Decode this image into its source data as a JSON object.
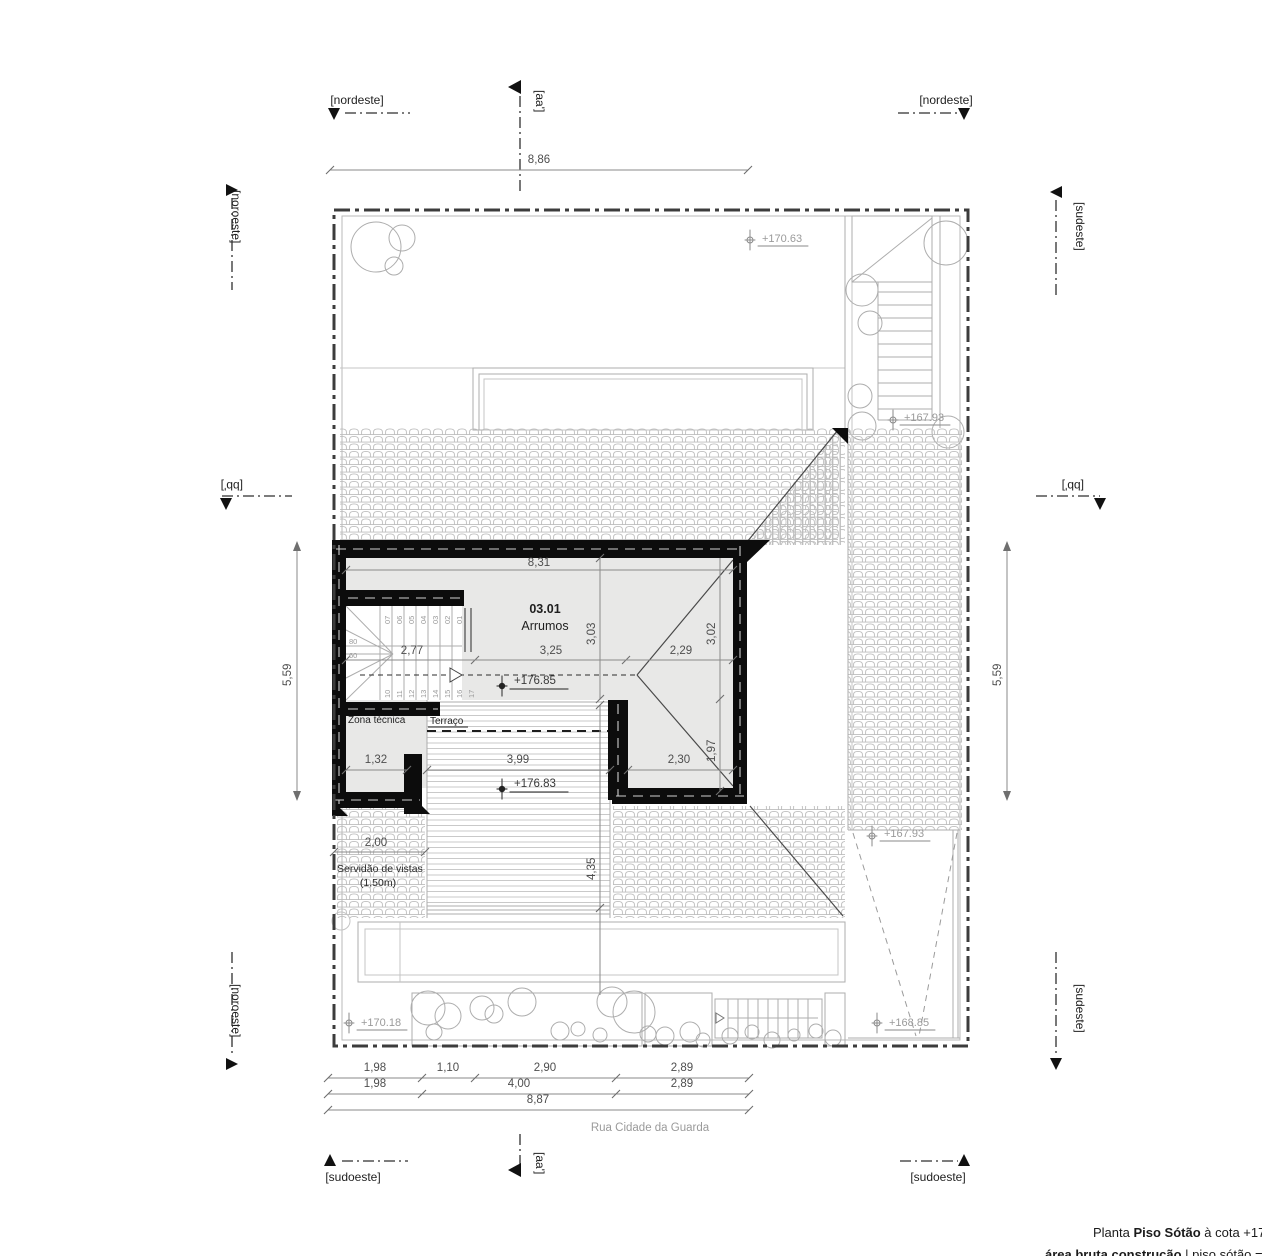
{
  "compass": {
    "nordeste": "[nordeste]",
    "noroeste": "[noroeste]",
    "sudeste": "[sudeste]",
    "sudoeste": "[sudoeste]"
  },
  "sections": {
    "aa": "[aa']",
    "bb": "[bb']"
  },
  "dims": {
    "top": "8,86",
    "side_left": "5,59",
    "side_right": "5,59",
    "room_width": "8,31",
    "room_depth_left": "3,03",
    "room_depth_right": "3,02",
    "room_lower_right": "1,97",
    "stair_width": "2,77",
    "mid_width": "3,25",
    "right_width": "2,29",
    "zona_width": "1,32",
    "terrace_width": "3,99",
    "lower_right_width": "2,30",
    "terrace_length": "4,35",
    "servidao_width": "2,00",
    "row1": [
      "1,98",
      "1,10",
      "2,90",
      "2,89"
    ],
    "row2": [
      "1,98",
      "4,00",
      "2,89"
    ],
    "row3": "8,87"
  },
  "elevations": {
    "garden_top": "+170.63",
    "stairs_top": "+167.93",
    "attic_floor": "+176.85",
    "terrace_floor": "+176.83",
    "roof_right": "+167.93",
    "garden_bottom": "+170.18",
    "ramp_bottom": "+168.85"
  },
  "rooms": {
    "arrumos_number": "03.01",
    "arrumos_name": "Arrumos",
    "zona_tecnica": "Zona técnica",
    "terraco": "Terraço"
  },
  "stair_steps": {
    "upper": [
      "07",
      "06",
      "05",
      "04",
      "03",
      "02",
      "01"
    ],
    "lower": [
      "10",
      "11",
      "12",
      "13",
      "14",
      "15",
      "16",
      "17"
    ],
    "rise_markers": [
      "80",
      "60"
    ]
  },
  "notes": {
    "servidao_line1": "Servidão de vistas",
    "servidao_line2": "(1,50m)",
    "street": "Rua Cidade da Guarda"
  },
  "title": {
    "plain1": "Planta ",
    "bold1": "Piso Sótão",
    "plain2": " à cota +17",
    "bold2": "área bruta construção",
    "plain3": " | piso sótão = 03"
  }
}
